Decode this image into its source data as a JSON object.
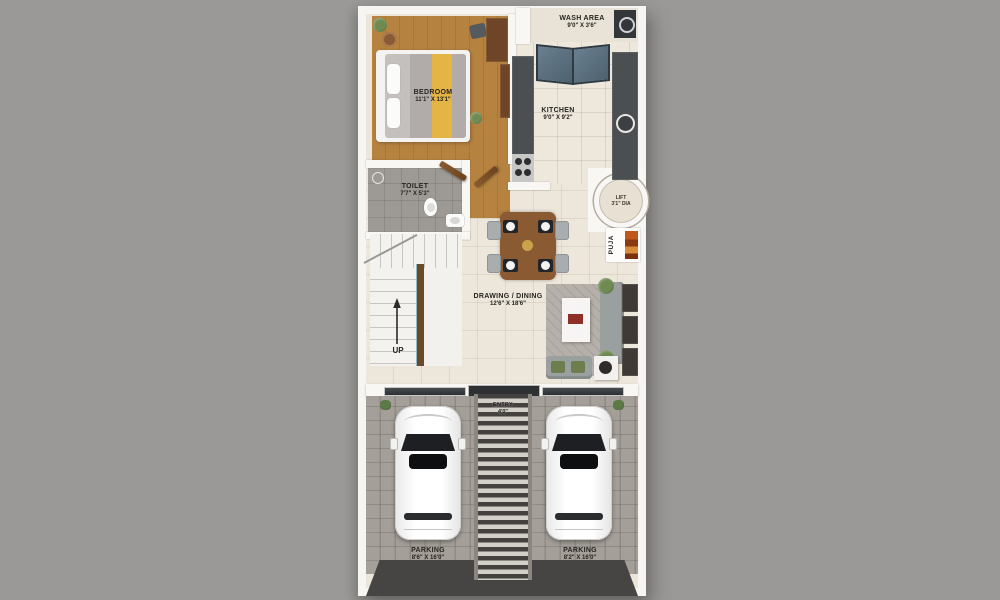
{
  "plan": {
    "bedroom": {
      "name": "BEDROOM",
      "dims": "11'1\" X 13'1\""
    },
    "wash_area": {
      "name": "WASH AREA",
      "dims": "9'0\" X 3'6\""
    },
    "kitchen": {
      "name": "KITCHEN",
      "dims": "9'0\" X 9'2\""
    },
    "toilet": {
      "name": "TOILET",
      "dims": "7'7\" X 5'3\""
    },
    "lift": {
      "name": "LIFT",
      "dims": "3'1\" DIA"
    },
    "puja": {
      "name": "PUJA"
    },
    "drawing_dining": {
      "name": "DRAWING / DINING",
      "dims": "12'6\" X 18'6\""
    },
    "stairs": {
      "up": "UP"
    },
    "entry": {
      "name": "ENTRY",
      "dims": "4'0\""
    },
    "parking_left": {
      "name": "PARKING",
      "dims": "8'6\" X 16'0\""
    },
    "parking_right": {
      "name": "PARKING",
      "dims": "8'2\" X 16'0\""
    }
  },
  "colors": {
    "background": "#9b9997",
    "walls": "#f8f7f4",
    "wood_floor": "#b5823f",
    "tile_floor": "#ece5da",
    "toilet_floor": "#9d9a95",
    "counter_dark": "#4b4f52",
    "glass_blue": "#5d7181",
    "bed_runner_yellow": "#e4b445",
    "puja_orange": "#c0561c",
    "parking_gray": "#a59f99",
    "driveway_dark": "#474543",
    "label_text": "#26241f"
  }
}
